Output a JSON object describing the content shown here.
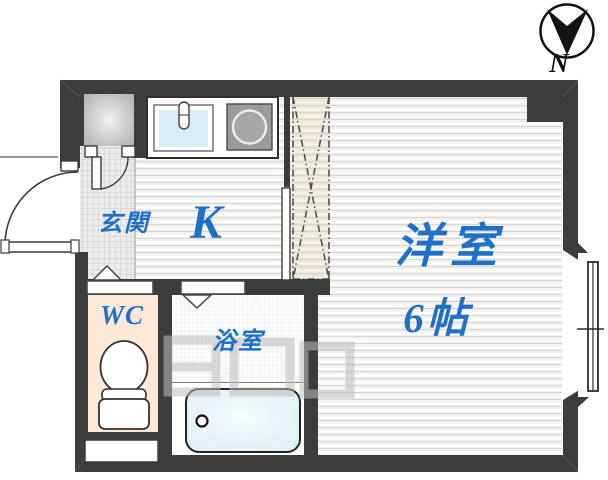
{
  "compass": {
    "label": "N"
  },
  "rooms": {
    "entrance": {
      "label": "玄関"
    },
    "kitchen": {
      "label": "K"
    },
    "western_room": {
      "name": "洋室",
      "size": "6帖"
    },
    "toilet": {
      "label": "WC"
    },
    "bathroom": {
      "label": "浴室"
    }
  },
  "colors": {
    "wall": "#3c3c3c",
    "label_blue": "#1f70c8",
    "wc_floor": "#fbe8d6",
    "sink": "#d9eef4",
    "stove": "#9b9b9b",
    "tub": "#e4f2f7"
  }
}
